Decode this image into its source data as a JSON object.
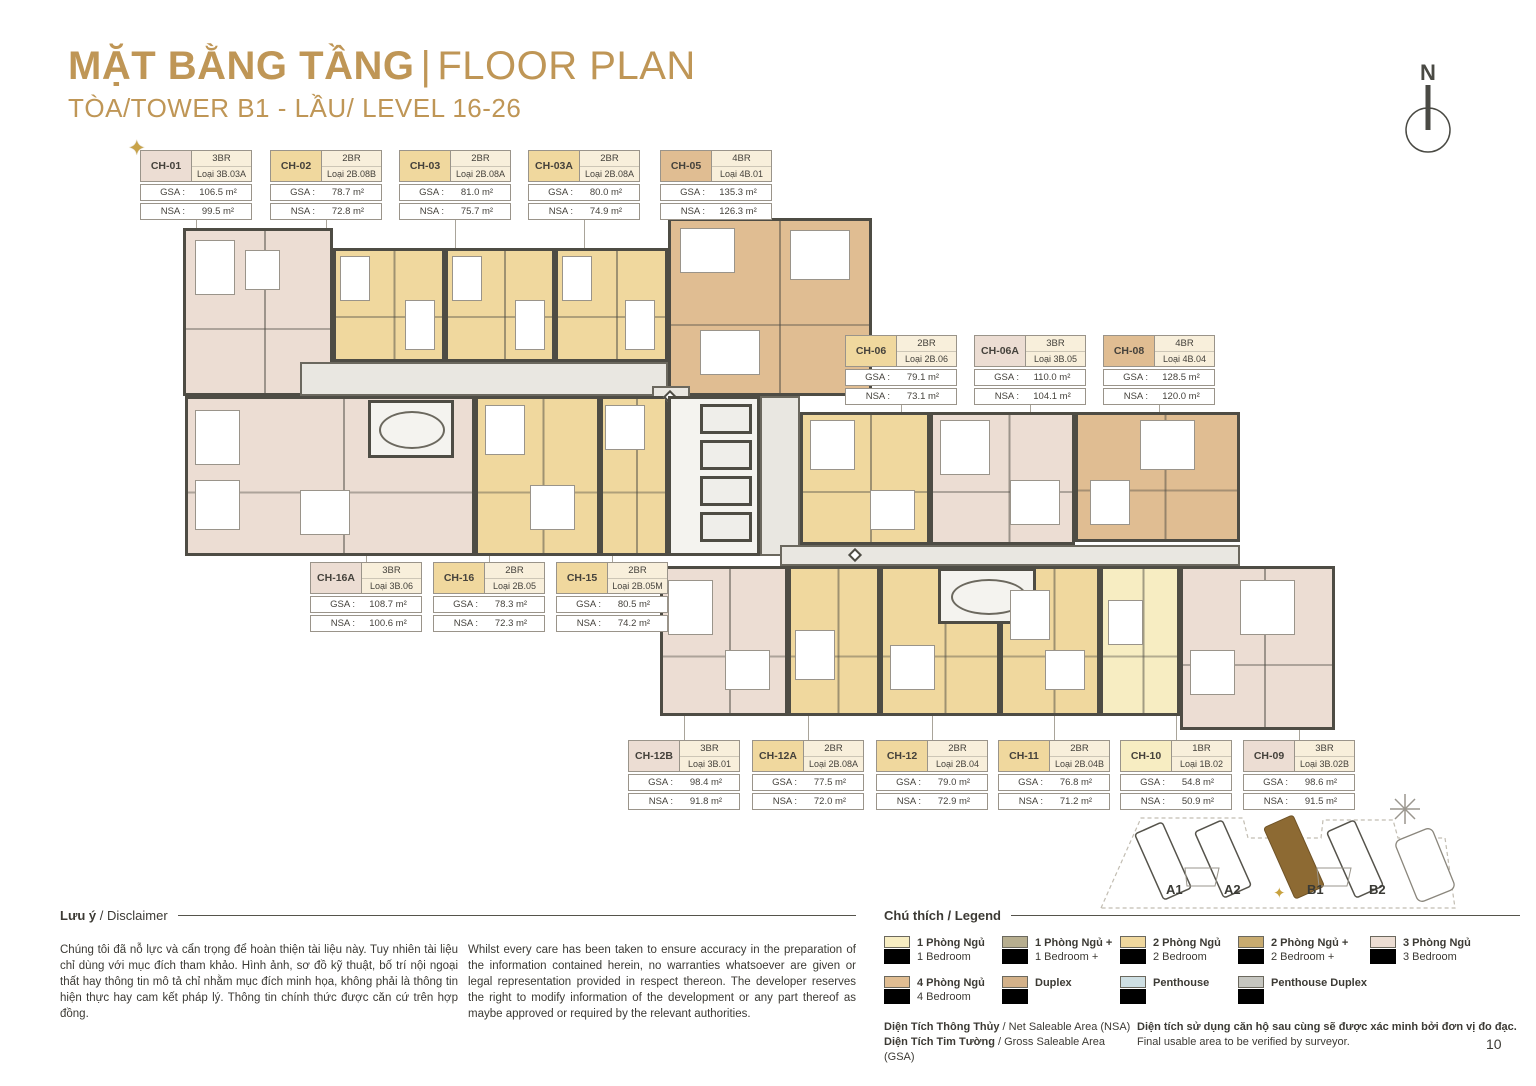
{
  "header": {
    "title_vn": "MẶT BẰNG TẦNG",
    "title_sep": "|",
    "title_en": "FLOOR PLAN",
    "subtitle": "TÒA/TOWER B1 - LẦU/ LEVEL 16-26",
    "compass_label": "N"
  },
  "labels": {
    "gsa": "GSA :",
    "nsa": "NSA :"
  },
  "icons": {
    "star": "✦"
  },
  "colors": {
    "accent_gold": "#bf9656",
    "1br": "#f7edc2",
    "1br_plus": "#b7ae8f",
    "2br": "#f0d89e",
    "2br_plus": "#c8ab70",
    "3br": "#ecddd3",
    "4br": "#e0bd92",
    "duplex": "#d3b189",
    "penthouse": "#cedfe3",
    "penthouse_duplex": "#c6c6c0",
    "wall": "#4e4c44",
    "highlight_building": "#8d6a33"
  },
  "cards": [
    {
      "id": "CH-01",
      "type": "3BR",
      "loai": "Loại 3B.03A",
      "gsa": "106.5 m²",
      "nsa": "99.5 m²",
      "color_key": "3br",
      "starred": true
    },
    {
      "id": "CH-02",
      "type": "2BR",
      "loai": "Loại 2B.08B",
      "gsa": "78.7 m²",
      "nsa": "72.8 m²",
      "color_key": "2br"
    },
    {
      "id": "CH-03",
      "type": "2BR",
      "loai": "Loại 2B.08A",
      "gsa": "81.0 m²",
      "nsa": "75.7 m²",
      "color_key": "2br"
    },
    {
      "id": "CH-03A",
      "type": "2BR",
      "loai": "Loại 2B.08A",
      "gsa": "80.0 m²",
      "nsa": "74.9 m²",
      "color_key": "2br"
    },
    {
      "id": "CH-05",
      "type": "4BR",
      "loai": "Loại 4B.01",
      "gsa": "135.3 m²",
      "nsa": "126.3 m²",
      "color_key": "4br"
    },
    {
      "id": "CH-06",
      "type": "2BR",
      "loai": "Loại 2B.06",
      "gsa": "79.1 m²",
      "nsa": "73.1 m²",
      "color_key": "2br"
    },
    {
      "id": "CH-06A",
      "type": "3BR",
      "loai": "Loại 3B.05",
      "gsa": "110.0 m²",
      "nsa": "104.1 m²",
      "color_key": "3br"
    },
    {
      "id": "CH-08",
      "type": "4BR",
      "loai": "Loại 4B.04",
      "gsa": "128.5 m²",
      "nsa": "120.0 m²",
      "color_key": "4br"
    },
    {
      "id": "CH-16A",
      "type": "3BR",
      "loai": "Loại 3B.06",
      "gsa": "108.7 m²",
      "nsa": "100.6 m²",
      "color_key": "3br"
    },
    {
      "id": "CH-16",
      "type": "2BR",
      "loai": "Loại 2B.05",
      "gsa": "78.3 m²",
      "nsa": "72.3 m²",
      "color_key": "2br"
    },
    {
      "id": "CH-15",
      "type": "2BR",
      "loai": "Loại 2B.05M",
      "gsa": "80.5 m²",
      "nsa": "74.2 m²",
      "color_key": "2br"
    },
    {
      "id": "CH-12B",
      "type": "3BR",
      "loai": "Loại 3B.01",
      "gsa": "98.4 m²",
      "nsa": "91.8 m²",
      "color_key": "3br"
    },
    {
      "id": "CH-12A",
      "type": "2BR",
      "loai": "Loại 2B.08A",
      "gsa": "77.5 m²",
      "nsa": "72.0 m²",
      "color_key": "2br"
    },
    {
      "id": "CH-12",
      "type": "2BR",
      "loai": "Loại 2B.04",
      "gsa": "79.0 m²",
      "nsa": "72.9 m²",
      "color_key": "2br"
    },
    {
      "id": "CH-11",
      "type": "2BR",
      "loai": "Loại 2B.04B",
      "gsa": "76.8 m²",
      "nsa": "71.2 m²",
      "color_key": "2br"
    },
    {
      "id": "CH-10",
      "type": "1BR",
      "loai": "Loại 1B.02",
      "gsa": "54.8 m²",
      "nsa": "50.9 m²",
      "color_key": "1br"
    },
    {
      "id": "CH-09",
      "type": "3BR",
      "loai": "Loại 3B.02B",
      "gsa": "98.6 m²",
      "nsa": "91.5 m²",
      "color_key": "3br"
    }
  ],
  "disclaimer": {
    "title_vn": "Lưu ý",
    "title_en": " / Disclaimer",
    "vn": "Chúng tôi đã nỗ lực và cẩn trọng để hoàn thiện tài liệu này. Tuy nhiên tài liệu chỉ dùng với mục đích tham khảo. Hình ảnh, sơ đồ kỹ thuật, bố trí nội ngoại thất hay thông tin mô tả chỉ nhằm mục đích minh họa, không phải là thông tin hiện thực hay cam kết pháp lý. Thông tin chính thức được căn cứ trên hợp đồng.",
    "en": "Whilst every care has been taken to ensure accuracy in the preparation of the information contained herein, no warranties whatsoever are given or legal representation provided in respect thereon. The developer reserves the right to modify information of the development or any part thereof as maybe approved or required by the relevant authorities."
  },
  "legend": {
    "title_vn": "Chú thích",
    "title_en": " / Legend",
    "items": [
      {
        "vn": "1 Phòng Ngủ",
        "en": "1 Bedroom",
        "color": "#f7edc2"
      },
      {
        "vn": "1 Phòng Ngủ +",
        "en": "1 Bedroom +",
        "color": "#b7ae8f"
      },
      {
        "vn": "2 Phòng Ngủ",
        "en": "2 Bedroom",
        "color": "#f0d89e"
      },
      {
        "vn": "2 Phòng Ngủ +",
        "en": "2 Bedroom +",
        "color": "#c8ab70"
      },
      {
        "vn": "3 Phòng Ngủ",
        "en": "3 Bedroom",
        "color": "#ecddd3"
      },
      {
        "vn": "4 Phòng Ngủ",
        "en": "4 Bedroom",
        "color": "#e0bd92"
      },
      {
        "vn": "Duplex",
        "en": "",
        "color": "#d3b189"
      },
      {
        "vn": "Penthouse",
        "en": "",
        "color": "#cedfe3"
      },
      {
        "vn": "Penthouse Duplex",
        "en": "",
        "color": "#c6c6c0"
      }
    ]
  },
  "area_notes": {
    "nsa_vn": "Diện Tích Thông Thủy",
    "nsa_en": " / Net Saleable Area (NSA)",
    "gsa_vn": "Diện Tích Tim Tường",
    "gsa_en": " / Gross Saleable Area (GSA)",
    "verify_vn": "Diện tích sử dụng căn hộ sau cùng sẽ được xác minh bởi đơn vị đo đạc.",
    "verify_en": "Final usable area to be verified by surveyor."
  },
  "sitemap": {
    "buildings": [
      "A1",
      "A2",
      "B1",
      "B2"
    ],
    "highlight": "B1"
  },
  "footer": {
    "page_number": "10"
  }
}
